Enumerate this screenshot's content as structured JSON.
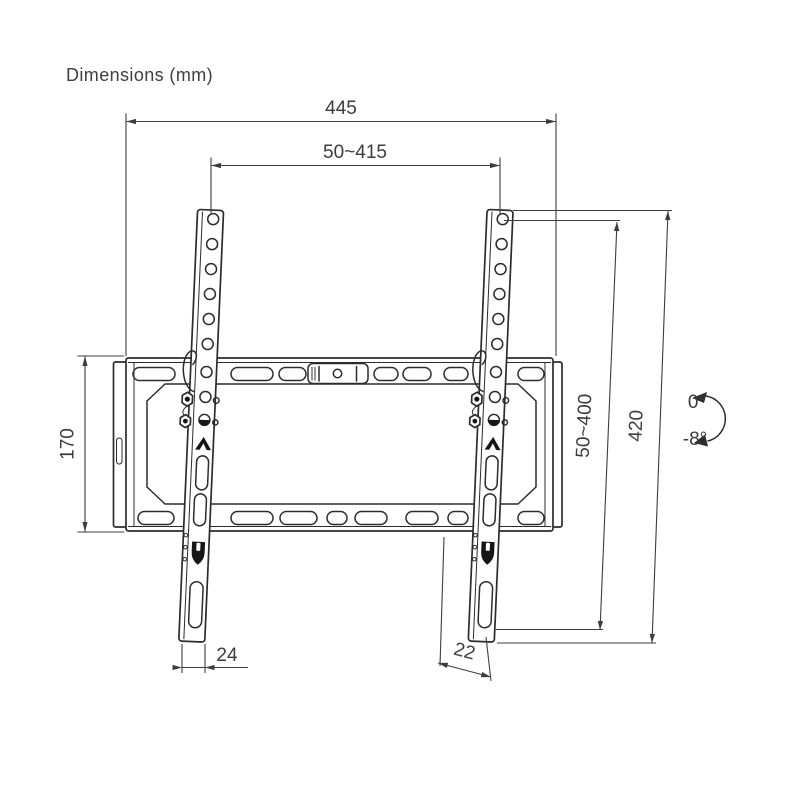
{
  "title": "Dimensions (mm)",
  "colors": {
    "background": "#ffffff",
    "drawing_line": "#2c2c2c",
    "dimension_line": "#3d3d3d",
    "text": "#3a3a3a",
    "clip_fill": "#161616"
  },
  "dimensions": {
    "overall_width": "445",
    "vesa_width_range": "50~415",
    "wall_plate_height": "170",
    "vesa_height_range": "50~400",
    "bracket_length": "420",
    "left_arm_bottom_width": "24",
    "right_arm_bottom_width": "22"
  },
  "tilt": {
    "max": "0°",
    "min": "-8°"
  }
}
